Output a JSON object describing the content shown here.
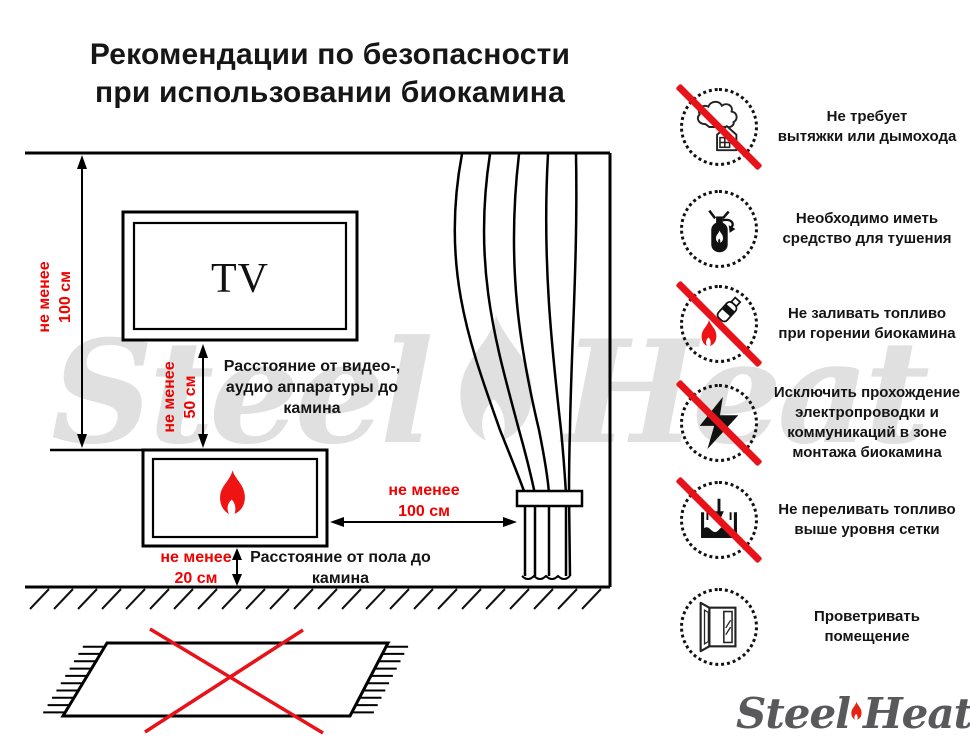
{
  "title": "Рекомендации по безопасности\nпри использовании биокамина",
  "watermark": {
    "left_word": "Steel",
    "right_word": "Heat"
  },
  "diagram": {
    "tv_label": "TV",
    "wall_dim": "не менее\n100 см",
    "av_dim": "не менее\n50 см",
    "av_note": "Расстояние от видео-,\nаудио аппаратуры до\nкамина",
    "curtain_dim": "не менее\n100 см",
    "floor_dim": "не менее\n20 см",
    "floor_note": "Расстояние от пола до\nкамина"
  },
  "rules": [
    {
      "icon": "no-chimney-icon",
      "crossed": true,
      "text": "Не требует\nвытяжки или дымохода"
    },
    {
      "icon": "extinguisher-icon",
      "crossed": false,
      "text": "Необходимо иметь\nсредство для тушения"
    },
    {
      "icon": "no-refuel-while-burning-icon",
      "crossed": true,
      "text": "Не заливать топливо\nпри горении биокамина"
    },
    {
      "icon": "no-wiring-in-mount-zone-icon",
      "crossed": true,
      "text": "Исключить прохождение\nэлектропроводки и\nкоммуникаций в зоне\nмонтажа биокамина"
    },
    {
      "icon": "no-overfill-icon",
      "crossed": true,
      "text": "Не переливать топливо\nвыше уровня сетки"
    },
    {
      "icon": "ventilation-icon",
      "crossed": false,
      "text": "Проветривать\nпомещение"
    }
  ],
  "logo": {
    "left_word": "Steel",
    "right_word": "Heat"
  },
  "colors": {
    "red_text": "#f10000",
    "red_mark": "#e8121a",
    "flame_red": "#ee1414",
    "watermark_gray": "#e0e0e0",
    "logo_gray": "#59595c"
  }
}
